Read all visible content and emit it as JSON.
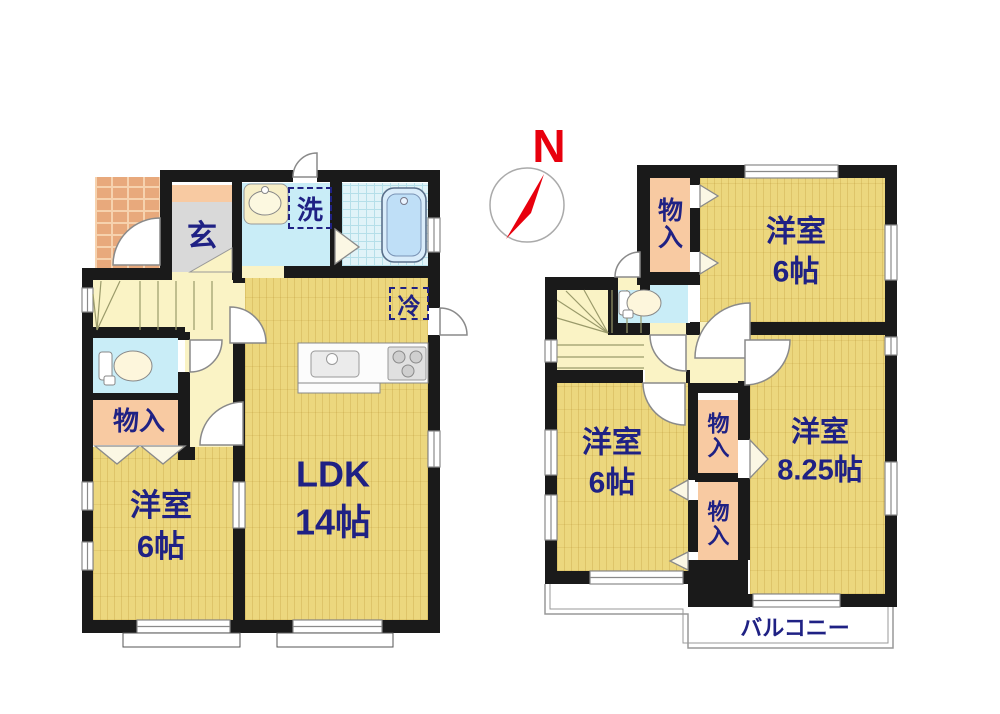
{
  "compass": {
    "north_label": "N"
  },
  "floor1": {
    "entrance": {
      "label": "玄"
    },
    "laundry_box": {
      "label": "洗"
    },
    "fridge_box": {
      "label": "冷"
    },
    "storage": {
      "label": "物入"
    },
    "western_room": {
      "name": "洋室",
      "size": "6帖"
    },
    "ldk": {
      "name": "LDK",
      "size": "14帖"
    }
  },
  "floor2": {
    "storage_northwest": {
      "label": "物入"
    },
    "room_northeast": {
      "name": "洋室",
      "size": "6帖"
    },
    "storage_middle_upper": {
      "label": "物入"
    },
    "storage_middle_lower": {
      "label": "物入"
    },
    "room_southwest": {
      "name": "洋室",
      "size": "6帖"
    },
    "room_southeast": {
      "name": "洋室",
      "size": "8.25帖"
    },
    "balcony": {
      "label": "バルコニー"
    }
  },
  "colors": {
    "wall": "#1a1a1a",
    "wood_floor": "#ecd77e",
    "hallway": "#faf3c5",
    "storage_peach": "#f8caa2",
    "water_blue": "#c9edf7",
    "bath_blue": "#e0f3f8",
    "entrance_gray": "#d9d9d9",
    "porch_brick": "#e8a97c",
    "label_navy": "#1f2184",
    "compass_red": "#e8000d"
  }
}
